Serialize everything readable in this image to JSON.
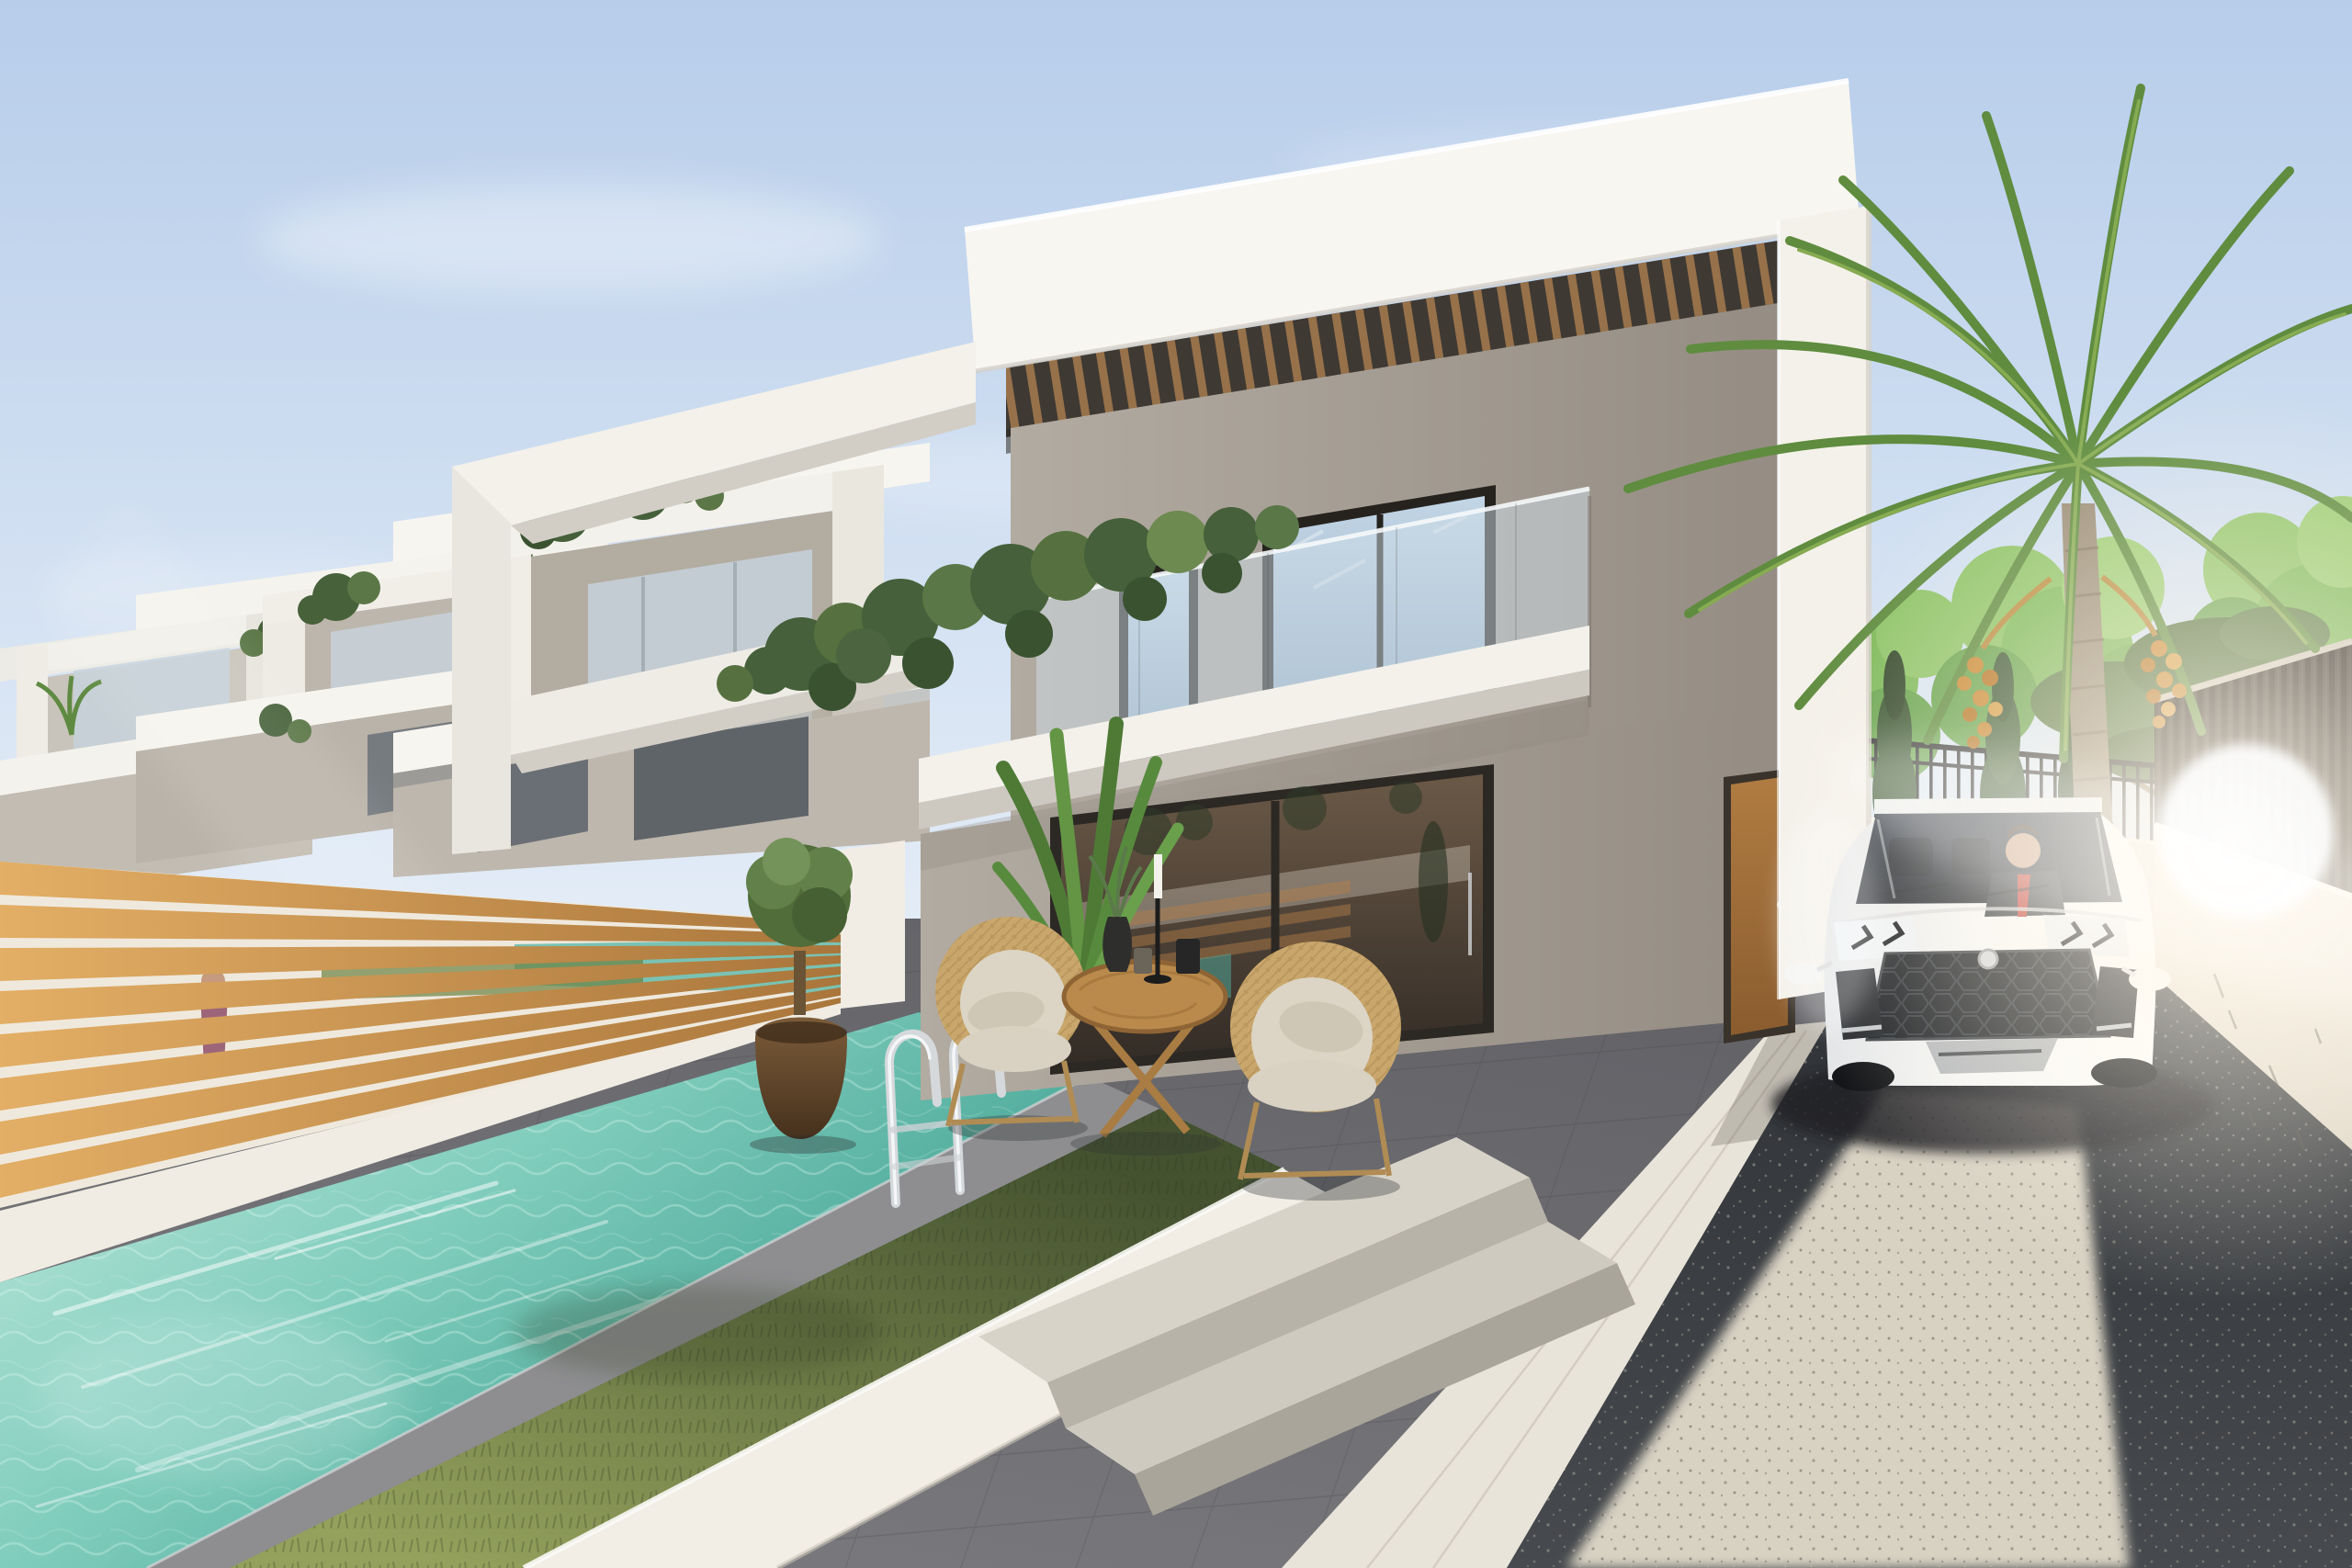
{
  "scene": {
    "description": "Photorealistic 3D architectural rendering: a modern two-storey white villa with wooden pergola, glass balustrade and ivy-draped balcony; turquoise private pool with chrome ladder and lawn strip in the lower left; grey tiled patio with two wicker armchairs and a round wooden folding table; a white luxury SUV with a suited driver parked on a gravel driveway at the right beside a cream boundary wall with a dark slatted fence; a tall date palm with orange fruit clusters, an umbrella pine, cypresses and green trees behind black railings; a row of identical villas recedes to the left behind a horizontal oak slat fence; bright sun flare washes over the car and wall."
  },
  "objects": [
    {
      "name": "modern-villa",
      "label": "Two-storey white modern villa with wooden pergola and glass balustrade"
    },
    {
      "name": "neighbor-villas",
      "label": "Row of identical villas receding to the left"
    },
    {
      "name": "swimming-pool",
      "label": "Turquoise private pool with chrome ladder"
    },
    {
      "name": "wooden-slat-fence",
      "label": "Horizontal oak slat fence between gardens"
    },
    {
      "name": "grass-strip",
      "label": "Lawn strip in a white planter beside the pool"
    },
    {
      "name": "patio",
      "label": "Dark grey tiled terrace with outdoor furniture"
    },
    {
      "name": "wicker-armchairs",
      "label": "Two rope-weave armchairs with beige cushions"
    },
    {
      "name": "folding-table",
      "label": "Round wooden folding table with vase, jars and candle"
    },
    {
      "name": "topiary-tree",
      "label": "Round topiary in a brown vase by the sliding door"
    },
    {
      "name": "banana-plant",
      "label": "Banana plant at the fence corner"
    },
    {
      "name": "sliding-glass-door",
      "label": "Bronze-tinted sliding glass door reflecting pool and fence"
    },
    {
      "name": "entry-door",
      "label": "Wooden side entrance door"
    },
    {
      "name": "suv-car",
      "label": "White luxury SUV with suited driver in the gravel driveway"
    },
    {
      "name": "driveway",
      "label": "Grey gravel driveway, sunlit in the foreground"
    },
    {
      "name": "boundary-wall",
      "label": "Cream boundary wall topped with dark slatted fence"
    },
    {
      "name": "metal-railing",
      "label": "Black metal railing on a low wall behind the car"
    },
    {
      "name": "cypress-trees",
      "label": "Slim cypress trees along the rear boundary"
    },
    {
      "name": "date-palm",
      "label": "Tall date palm with orange date clusters"
    },
    {
      "name": "stone-pine",
      "label": "Umbrella pine behind the right fence"
    },
    {
      "name": "sun-flare",
      "label": "Bright sun flare over car and wall"
    },
    {
      "name": "sky",
      "label": "Clear pale blue sky with thin haze"
    }
  ],
  "palette": {
    "sky_top": "#b7cdea",
    "sky_mid": "#dde8f5",
    "sky_horizon": "#f4f7fb",
    "white_bright": "#f8f6f1",
    "white_warm": "#f3f1ea",
    "white_shade": "#d2cec6",
    "taupe_light": "#b2aba1",
    "taupe_dark": "#958d83",
    "wood_light": "#e3ae65",
    "wood_dark": "#a8743a",
    "wood_pergola": "#96714a",
    "window_sky_light": "#c3d6e6",
    "window_sky_dark": "#8fa9c0",
    "balustrade_glass": "#cfdde8",
    "door_glass_light": "#6b5947",
    "door_glass_dark": "#332c26",
    "door_wood_light": "#b07c42",
    "door_wood_dark": "#8a5c2e",
    "water_light": "#c6ecdf",
    "water_mid": "#7fccbc",
    "water_deep": "#47a596",
    "grass_light": "#94a15c",
    "grass_dark": "#445230",
    "patio_light": "#7d7d81",
    "patio_dark": "#606065",
    "walkway": "#e9e4d9",
    "gravel_dark": "#474a4e",
    "gravel_darker": "#2e3135",
    "gravel_bright": "#d8d2c3",
    "wall_cream_light": "#f8f2e7",
    "wall_cream_dark": "#ddd5c6",
    "fence_dark": "#3b352f",
    "railing_black": "#282828",
    "foliage_bright": "#7db959",
    "foliage_mid": "#64a14b",
    "foliage_dark": "#45603a",
    "cypress_green": "#3c5733",
    "pine_green": "#5d7c49",
    "palm_green": "#5f8c3f",
    "palm_green_light": "#86ab52",
    "palm_trunk": "#9b8e78",
    "dates_orange": "#c8862f",
    "wicker": "#c9a76c",
    "cushion": "#dcd5c6",
    "pot_light": "#7c5c39",
    "pot_dark": "#46311d",
    "car_white": "#f7f7f6",
    "car_grey": "#e3e5e7",
    "windshield_light": "#39404c",
    "windshield_dark": "#23272e",
    "tie_red": "#c03a32",
    "flare": "#fff9ec"
  }
}
